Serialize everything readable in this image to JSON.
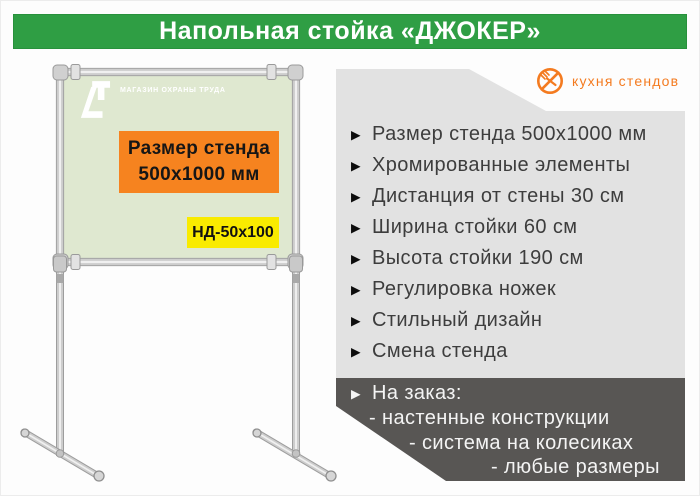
{
  "page": {
    "title": "Напольная стойка «ДЖОКЕР»"
  },
  "brand": {
    "name": "кухня стендов"
  },
  "stand": {
    "board_logo_text": "МАГАЗИН ОХРАНЫ ТРУДА",
    "size_box": {
      "line1": "Размер стенда",
      "line2": "500x1000  мм"
    },
    "model_label": "НД-50x100"
  },
  "features": {
    "bullet": "▶",
    "items": [
      "Размер стенда 500x1000 мм",
      "Хромированные элементы",
      "Дистанция от стены 30 см",
      "Ширина стойки 60 см",
      "Высота стойки 190 см",
      "Регулировка ножек",
      "Стильный дизайн",
      "Смена стенда"
    ]
  },
  "custom_order": {
    "bullet": "▶",
    "title": "На заказ:",
    "items": [
      "- настенные конструкции",
      "- система на колесиках",
      "- любые размеры"
    ]
  },
  "colors": {
    "header_green": "#2f9e44",
    "brand_orange": "#f47b20",
    "size_box_orange": "#f6831f",
    "model_box_yellow": "#f9eb00",
    "board_green": "#dfe8d0",
    "panel_gray": "#e2e2e2",
    "dark_panel_gray": "#585654"
  }
}
